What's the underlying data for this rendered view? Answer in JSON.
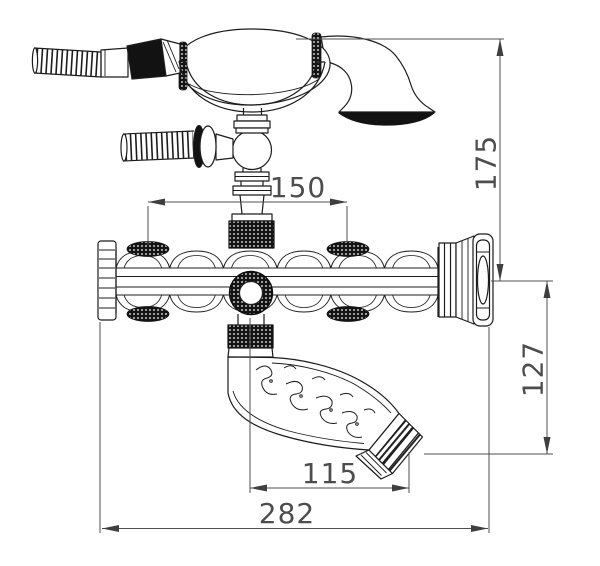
{
  "title": "Bathtub faucet with hand shower - dimensioned technical drawing",
  "colors": {
    "background": "#ffffff",
    "line": "#1c1c1c",
    "black_fill": "#121212",
    "dimension_line": "#4f4f4f",
    "dimension_text": "#4d4d4d"
  },
  "dimensions": {
    "shower_height": {
      "value": "175",
      "orientation": "vertical"
    },
    "inlet_spacing": {
      "value": "150",
      "orientation": "horizontal"
    },
    "spout_drop": {
      "value": "127",
      "orientation": "vertical"
    },
    "spout_reach": {
      "value": "115",
      "orientation": "horizontal"
    },
    "overall_width": {
      "value": "282",
      "orientation": "horizontal"
    }
  },
  "parts": [
    "shower-hose",
    "hand-shower",
    "shower-cradle",
    "inlet-hose",
    "riser-pipe",
    "valve-body",
    "control-knob",
    "tub-spout"
  ]
}
